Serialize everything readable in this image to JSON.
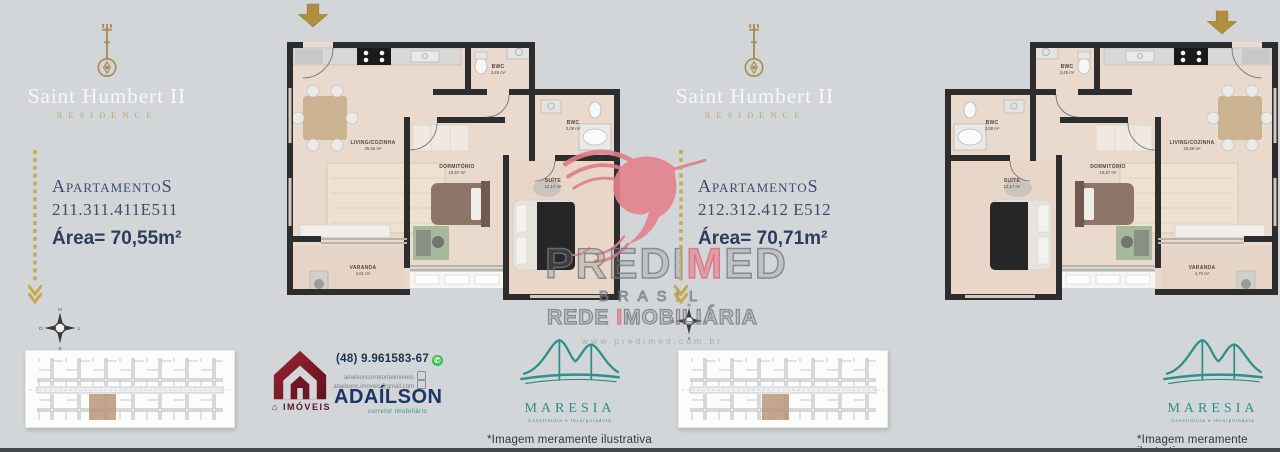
{
  "brand": {
    "title": "Saint Humbert II",
    "subtitle": "RESIDENCE"
  },
  "left": {
    "apartments_label": "ApartamentoS",
    "apartments_numbers": "211.311.411E511",
    "area": "Área= 70,55m²",
    "disclaimer": "*Imagem meramente ilustrativa",
    "rooms": {
      "living": {
        "name": "LIVING/COZINHA",
        "area": "25,66 m²"
      },
      "bwc1": {
        "name": "BWC",
        "area": "3,49 m²"
      },
      "bwc2": {
        "name": "BWC",
        "area": "3,08 m²"
      },
      "dorm": {
        "name": "DORMITÓRIO",
        "area": "10,57 m²"
      },
      "suite": {
        "name": "SUÍTE",
        "area": "12,17 m²"
      },
      "varanda": {
        "name": "VARANDA",
        "area": "4,81 m²"
      }
    }
  },
  "right": {
    "apartments_label": "ApartamentoS",
    "apartments_numbers": "212.312.412 E512",
    "area": "Área= 70,71m²",
    "disclaimer": "*Imagem meramente ilustrativa",
    "rooms": {
      "living": {
        "name": "LIVING/COZINHA",
        "area": "25,66 m²"
      },
      "bwc1": {
        "name": "BWC",
        "area": "3,49 m²"
      },
      "bwc2": {
        "name": "BWC",
        "area": "3,08 m²"
      },
      "dorm": {
        "name": "DORMITÓRIO",
        "area": "10,57 m²"
      },
      "suite": {
        "name": "SUÍTE",
        "area": "12,17 m²"
      },
      "varanda": {
        "name": "VARANDA",
        "area": "4,70 m²"
      }
    }
  },
  "watermark": {
    "name_pre": "PREDI",
    "name_mid": "M",
    "name_post": "ED",
    "line2": "BRASIL",
    "line3_pre": "REDE ",
    "line3_mid": "I",
    "line3_post": "MOBILIÁRIA",
    "url": "www.predimed.com.br"
  },
  "realtor": {
    "phone": "(48) 9.961583-67",
    "instagram": "adailsoncorretordeimoveis",
    "email": "adailsonc.imoveis@gmail.com",
    "name": "ADAÍLSON",
    "tagline": "corretor imobiliário",
    "imoveis_label": "IMÓVEIS"
  },
  "builder": {
    "name": "MARESIA",
    "tagline": "Construtora e Incorporadora"
  },
  "compass": {
    "n": "N",
    "s": "S",
    "e": "L",
    "w": "O"
  },
  "colors": {
    "background": "#d3d6d9",
    "gold": "#b2954f",
    "navy": "#2c3c5a",
    "maroon": "#7a1c2c",
    "teal": "#2f8f8a",
    "watermark_pink": "#e4828c",
    "wall": "#2d2d2d",
    "floor": "#ead9cd"
  }
}
